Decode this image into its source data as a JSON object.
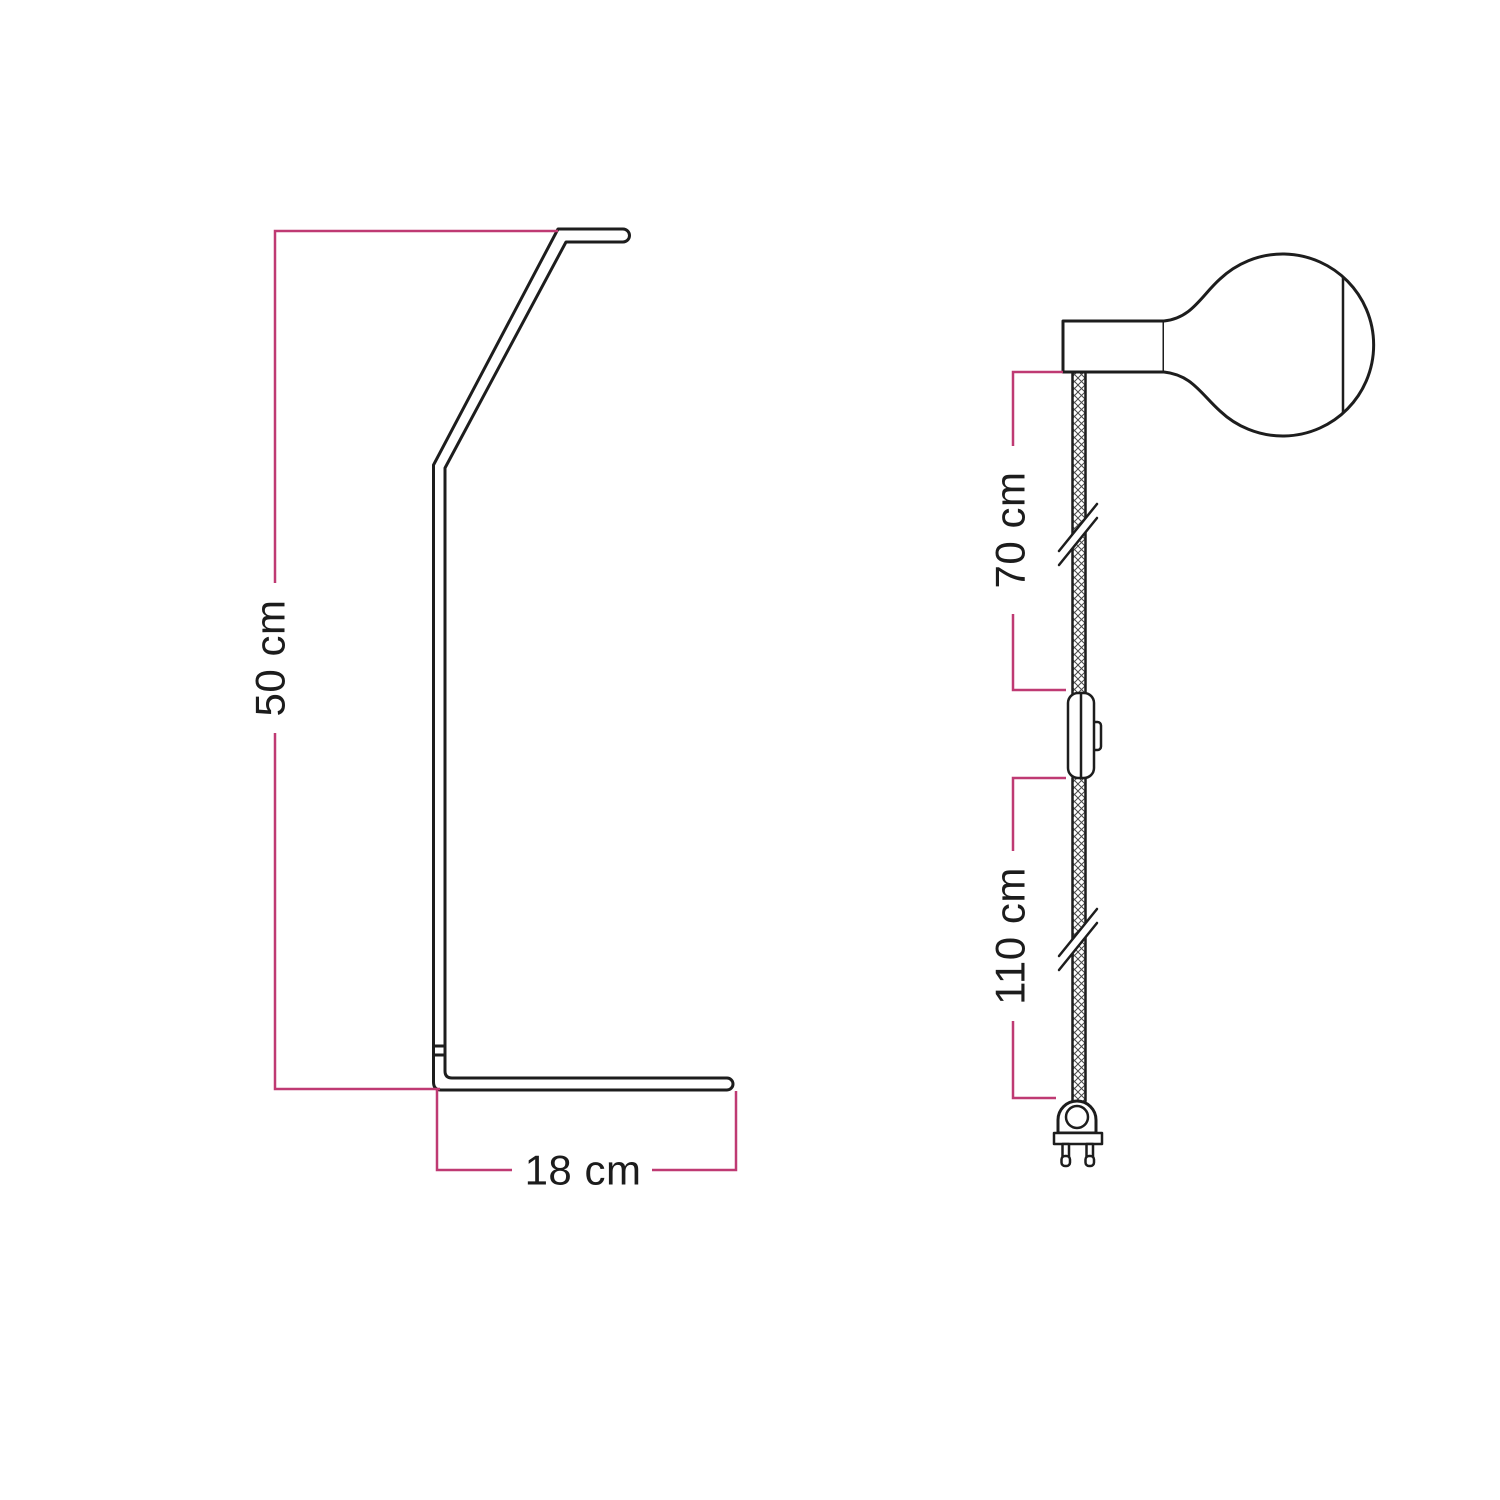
{
  "colors": {
    "background": "#ffffff",
    "line": "#1d1d1d",
    "hatch": "#4a4a4a",
    "dimension": "#bf3a73",
    "text": "#1c1c1c"
  },
  "dimensions": {
    "stand_height": "50 cm",
    "base_width": "18 cm",
    "upper_cable": "70 cm",
    "lower_cable": "110 cm"
  }
}
